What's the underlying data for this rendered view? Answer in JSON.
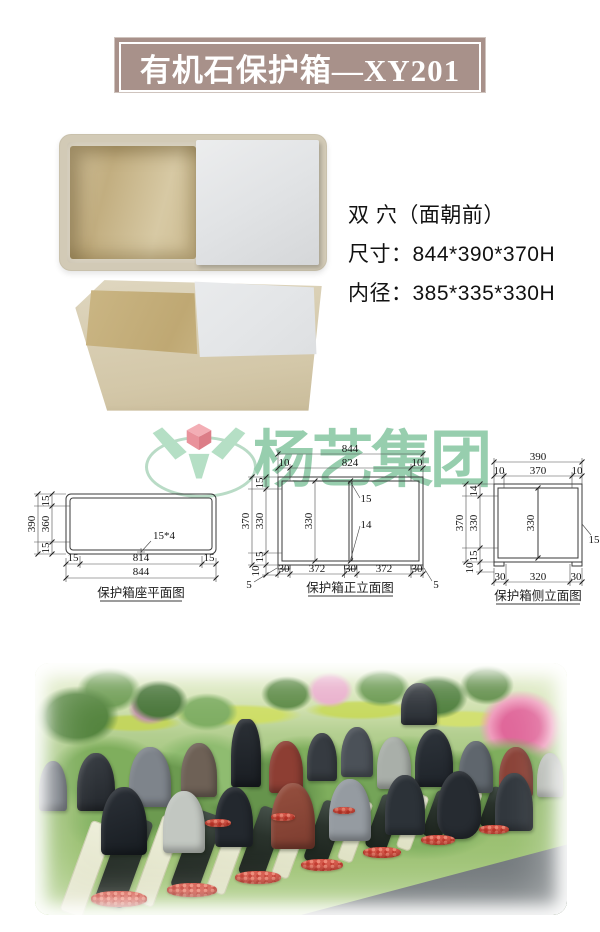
{
  "banner": {
    "title": "有机石保护箱—XY201"
  },
  "specs": {
    "line1": "双 穴（面朝前）",
    "line2": "尺寸：844*390*370H",
    "line3": "内径：385*335*330H"
  },
  "watermark": {
    "brand": "杨艺集团"
  },
  "drawings": {
    "plan": {
      "caption": "保护箱座平面图",
      "total_width": "844",
      "inner_width": "814",
      "wall": "15",
      "total_depth": "390",
      "inner_depth": "360",
      "hole_note": "15*4"
    },
    "front": {
      "caption": "保护箱正立面图",
      "total_width": "844",
      "top_width": "824",
      "top_edge": "10",
      "total_height": "370",
      "rim": "15",
      "inner_height": "330",
      "base": "10",
      "foot": "5",
      "divider_upper": "15",
      "divider_lower": "14",
      "cell_width": "372",
      "post": "30"
    },
    "side": {
      "caption": "保护箱侧立面图",
      "total_width": "390",
      "top_width": "370",
      "top_edge": "10",
      "total_height": "370",
      "rim_top": "14",
      "inner_height": "330",
      "rim_bottom": "15",
      "base": "10",
      "wall": "15",
      "post": "30",
      "cell_width": "320"
    }
  },
  "colors": {
    "banner_bg": "#a8918a",
    "banner_text": "#ffffff",
    "drawing_line": "#3a3a3a",
    "watermark_green": "#8cc9a6",
    "watermark_pink": "#f2a6ae"
  }
}
